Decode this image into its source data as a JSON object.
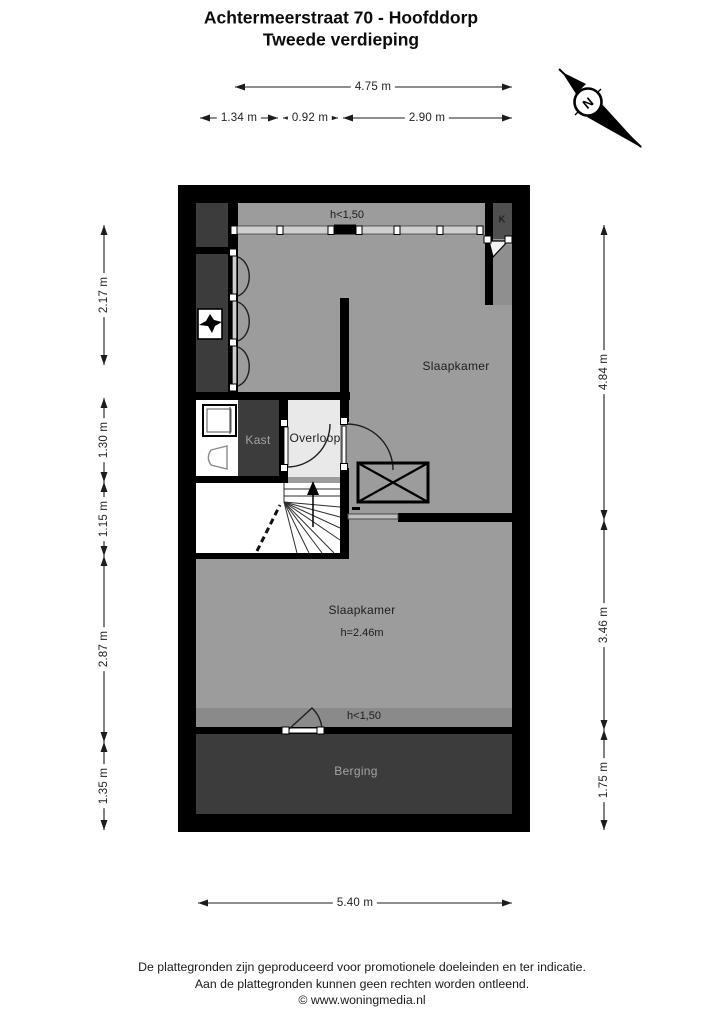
{
  "title": {
    "line1": "Achtermeerstraat 70 - Hoofddorp",
    "line2": "Tweede verdieping"
  },
  "compass": {
    "north_label": "N"
  },
  "plan": {
    "rooms": {
      "slaapkamer_top": {
        "label": "Slaapkamer"
      },
      "slaapkamer_bottom": {
        "label": "Slaapkamer",
        "height_note": "h=2.46m"
      },
      "kast": {
        "label": "Kast"
      },
      "overloop": {
        "label": "Overloop"
      },
      "berging": {
        "label": "Berging"
      },
      "k_closet": {
        "label": "K"
      }
    },
    "height_notes": {
      "top": "h<1,50",
      "bottom": "h<1,50"
    }
  },
  "dimensions": {
    "top_total": "4.75 m",
    "top_segments": [
      "1.34 m",
      "0.92 m",
      "2.90 m"
    ],
    "left": [
      "2.17 m",
      "1.30 m",
      "1.15 m",
      "2.87 m",
      "1.35 m"
    ],
    "right": [
      "4.84 m",
      "3.46 m",
      "1.75 m"
    ],
    "bottom_total": "5.40 m"
  },
  "footer": {
    "line1": "De plattegronden zijn geproduceerd voor promotionele doeleinden en ter indicatie.",
    "line2": "Aan de plattegronden kunnen geen rechten worden ontleend.",
    "line3": "© www.woningmedia.nl"
  },
  "colors": {
    "wall": "#000000",
    "room": "#9c9c9c",
    "low_ceiling_band": "#8a8a8a",
    "dark_zone": "#3c3c3c",
    "k_closet": "#4f4f4f",
    "k_strip": "#8f8f8f",
    "landing": "#e9e9e9",
    "glazing": "#cfcfcf"
  }
}
